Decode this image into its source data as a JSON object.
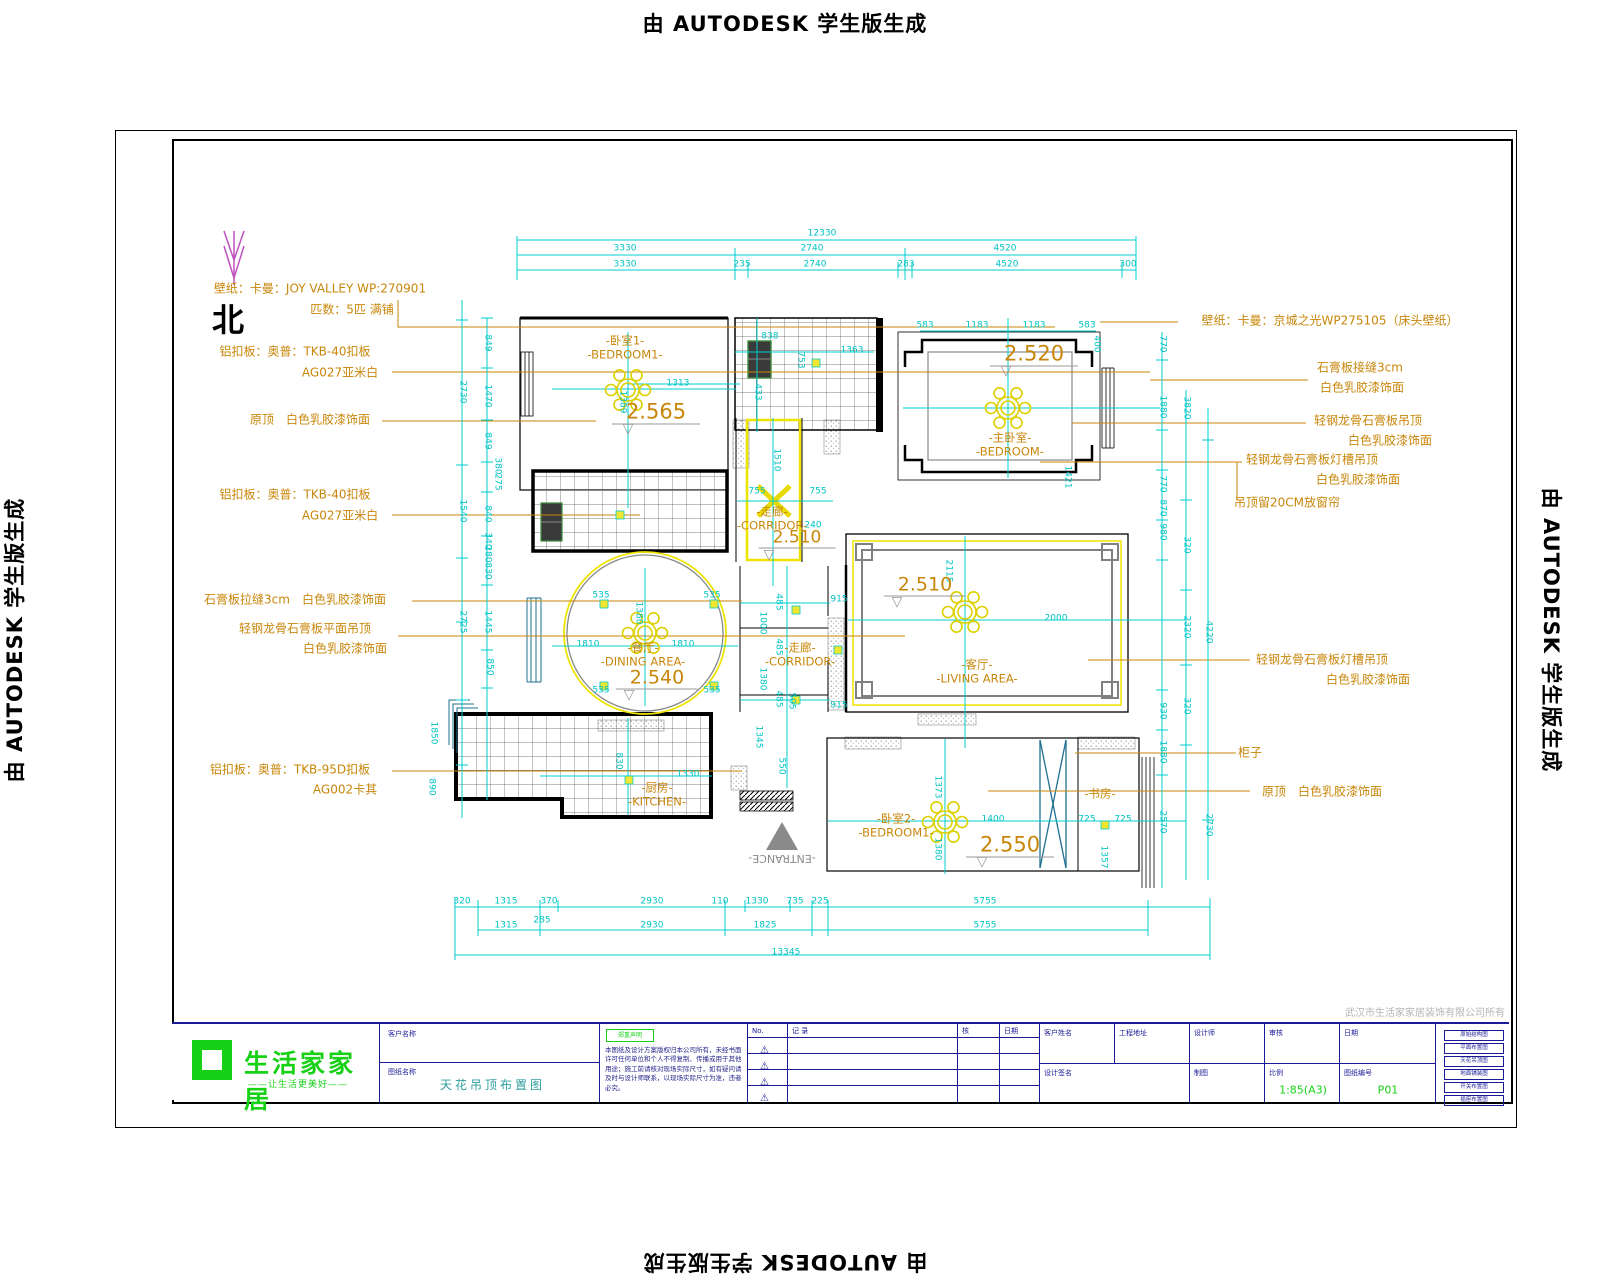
{
  "watermark": {
    "text": "由 AUTODESK 学生版生成"
  },
  "north_label": "北",
  "company_note": "武汉市生活家家居装饰有限公司所有",
  "plan": {
    "annotations": [
      {
        "t": "壁纸：卡曼：JOY VALLEY WP:270901",
        "x": 320,
        "y": 289
      },
      {
        "t": "匹数：5匹 满铺",
        "x": 352,
        "y": 310
      },
      {
        "t": "铝扣板：奥普：TKB-40扣板",
        "x": 295,
        "y": 352
      },
      {
        "t": "AG027亚米白",
        "x": 340,
        "y": 373
      },
      {
        "t": "原顶　白色乳胶漆饰面",
        "x": 310,
        "y": 420
      },
      {
        "t": "铝扣板：奥普：TKB-40扣板",
        "x": 295,
        "y": 495
      },
      {
        "t": "AG027亚米白",
        "x": 340,
        "y": 516
      },
      {
        "t": "石膏板拉缝3cm　白色乳胶漆饰面",
        "x": 295,
        "y": 600
      },
      {
        "t": "轻钢龙骨石膏板平面吊顶",
        "x": 305,
        "y": 629
      },
      {
        "t": "白色乳胶漆饰面",
        "x": 345,
        "y": 649
      },
      {
        "t": "铝扣板：奥普：TKB-95D扣板",
        "x": 290,
        "y": 770
      },
      {
        "t": "AG002卡其",
        "x": 345,
        "y": 790
      },
      {
        "t": "壁纸：卡曼：京城之光WP275105（床头壁纸）",
        "x": 1330,
        "y": 321
      },
      {
        "t": "石膏板接缝3cm",
        "x": 1360,
        "y": 368
      },
      {
        "t": "白色乳胶漆饰面",
        "x": 1362,
        "y": 388
      },
      {
        "t": "轻钢龙骨石膏板吊顶",
        "x": 1368,
        "y": 421
      },
      {
        "t": "白色乳胶漆饰面",
        "x": 1390,
        "y": 441
      },
      {
        "t": "轻钢龙骨石膏板灯槽吊顶",
        "x": 1312,
        "y": 460
      },
      {
        "t": "白色乳胶漆饰面",
        "x": 1358,
        "y": 480
      },
      {
        "t": "吊顶留20CM放窗帘",
        "x": 1287,
        "y": 503
      },
      {
        "t": "轻钢龙骨石膏板灯槽吊顶",
        "x": 1322,
        "y": 660
      },
      {
        "t": "白色乳胶漆饰面",
        "x": 1368,
        "y": 680
      },
      {
        "t": "柜子",
        "x": 1250,
        "y": 753
      },
      {
        "t": "原顶　白色乳胶漆饰面",
        "x": 1322,
        "y": 792
      },
      {
        "t": "-ENTRANCE-",
        "x": 782,
        "y": 858,
        "r": 180,
        "c": "#8a8a8a",
        "s": 11
      }
    ],
    "rooms": [
      {
        "cn": "-卧室1-",
        "en": "-BEDROOM1-",
        "x": 625,
        "y": 341
      },
      {
        "cn": "-主卧室-",
        "en": "-BEDROOM-",
        "x": 1010,
        "y": 438
      },
      {
        "cn": "-走廊-",
        "en": "-CORRIDOR-",
        "x": 772,
        "y": 512
      },
      {
        "cn": "-餐厅-",
        "en": "-DINING AREA-",
        "x": 643,
        "y": 648
      },
      {
        "cn": "-走廊-",
        "en": "-CORRIDOR-",
        "x": 800,
        "y": 648
      },
      {
        "cn": "-客厅-",
        "en": "-LIVING AREA-",
        "x": 977,
        "y": 665
      },
      {
        "cn": "-厨房-",
        "en": "-KITCHEN-",
        "x": 657,
        "y": 788
      },
      {
        "cn": "-卧室2-",
        "en": "-BEDROOM1-",
        "x": 896,
        "y": 819
      },
      {
        "cn": "-书房-",
        "en": "",
        "x": 1100,
        "y": 794
      }
    ],
    "levels": [
      {
        "t": "2.565",
        "x": 656,
        "y": 413,
        "s": 21
      },
      {
        "t": "2.520",
        "x": 1034,
        "y": 355,
        "s": 21
      },
      {
        "t": "2.510",
        "x": 797,
        "y": 539,
        "s": 17
      },
      {
        "t": "2.540",
        "x": 657,
        "y": 679,
        "s": 19
      },
      {
        "t": "2.510",
        "x": 925,
        "y": 586,
        "s": 19
      },
      {
        "t": "2.550",
        "x": 1010,
        "y": 846,
        "s": 21
      }
    ],
    "dims": [
      {
        "t": "12330",
        "x": 822,
        "y": 234
      },
      {
        "t": "3330",
        "x": 625,
        "y": 249
      },
      {
        "t": "2740",
        "x": 812,
        "y": 249
      },
      {
        "t": "4520",
        "x": 1005,
        "y": 249
      },
      {
        "t": "3330",
        "x": 625,
        "y": 265
      },
      {
        "t": "235",
        "x": 742,
        "y": 265
      },
      {
        "t": "2740",
        "x": 815,
        "y": 265
      },
      {
        "t": "283",
        "x": 906,
        "y": 265
      },
      {
        "t": "4520",
        "x": 1007,
        "y": 265
      },
      {
        "t": "300",
        "x": 1128,
        "y": 265
      },
      {
        "t": "320",
        "x": 462,
        "y": 902
      },
      {
        "t": "1315",
        "x": 506,
        "y": 902
      },
      {
        "t": "370",
        "x": 549,
        "y": 902
      },
      {
        "t": "2930",
        "x": 652,
        "y": 902
      },
      {
        "t": "110",
        "x": 720,
        "y": 902
      },
      {
        "t": "1330",
        "x": 757,
        "y": 902
      },
      {
        "t": "735",
        "x": 795,
        "y": 902
      },
      {
        "t": "225",
        "x": 820,
        "y": 902
      },
      {
        "t": "5755",
        "x": 985,
        "y": 902
      },
      {
        "t": "1315",
        "x": 506,
        "y": 926
      },
      {
        "t": "285",
        "x": 542,
        "y": 921
      },
      {
        "t": "2930",
        "x": 652,
        "y": 926
      },
      {
        "t": "1825",
        "x": 765,
        "y": 926
      },
      {
        "t": "5755",
        "x": 985,
        "y": 926
      },
      {
        "t": "13345",
        "x": 786,
        "y": 953
      },
      {
        "t": "849",
        "x": 487,
        "y": 343,
        "r": 90
      },
      {
        "t": "2730",
        "x": 462,
        "y": 392,
        "r": 90
      },
      {
        "t": "1470",
        "x": 487,
        "y": 396,
        "r": 90
      },
      {
        "t": "849",
        "x": 487,
        "y": 441,
        "r": 90
      },
      {
        "t": "380",
        "x": 497,
        "y": 466,
        "r": 90
      },
      {
        "t": "275",
        "x": 497,
        "y": 482,
        "r": 90
      },
      {
        "t": "1540",
        "x": 462,
        "y": 511,
        "r": 90
      },
      {
        "t": "840",
        "x": 487,
        "y": 514,
        "r": 90
      },
      {
        "t": "340",
        "x": 487,
        "y": 541,
        "r": 90
      },
      {
        "t": "280",
        "x": 487,
        "y": 554,
        "r": 90
      },
      {
        "t": "830",
        "x": 487,
        "y": 571,
        "r": 90
      },
      {
        "t": "2725",
        "x": 462,
        "y": 622,
        "r": 90
      },
      {
        "t": "1445",
        "x": 487,
        "y": 622,
        "r": 90
      },
      {
        "t": "850",
        "x": 489,
        "y": 667,
        "r": 90
      },
      {
        "t": "1850",
        "x": 433,
        "y": 733,
        "r": 90
      },
      {
        "t": "890",
        "x": 431,
        "y": 787,
        "r": 90
      },
      {
        "t": "770",
        "x": 1162,
        "y": 344,
        "r": 90
      },
      {
        "t": "1880",
        "x": 1162,
        "y": 407,
        "r": 90
      },
      {
        "t": "770",
        "x": 1162,
        "y": 484,
        "r": 90
      },
      {
        "t": "870",
        "x": 1162,
        "y": 508,
        "r": 90
      },
      {
        "t": "980",
        "x": 1162,
        "y": 532,
        "r": 90
      },
      {
        "t": "930",
        "x": 1162,
        "y": 711,
        "r": 90
      },
      {
        "t": "1880",
        "x": 1162,
        "y": 752,
        "r": 90
      },
      {
        "t": "2570",
        "x": 1162,
        "y": 822,
        "r": 90
      },
      {
        "t": "3820",
        "x": 1186,
        "y": 408,
        "r": 90
      },
      {
        "t": "320",
        "x": 1186,
        "y": 545,
        "r": 90
      },
      {
        "t": "2320",
        "x": 1186,
        "y": 627,
        "r": 90
      },
      {
        "t": "320",
        "x": 1186,
        "y": 706,
        "r": 90
      },
      {
        "t": "4220",
        "x": 1208,
        "y": 632,
        "r": 90
      },
      {
        "t": "2730",
        "x": 1208,
        "y": 825,
        "r": 90
      },
      {
        "t": "1313",
        "x": 678,
        "y": 384
      },
      {
        "t": "1389",
        "x": 622,
        "y": 402,
        "r": 90
      },
      {
        "t": "838",
        "x": 770,
        "y": 337
      },
      {
        "t": "433",
        "x": 757,
        "y": 392,
        "r": 90
      },
      {
        "t": "1363",
        "x": 852,
        "y": 351
      },
      {
        "t": "753",
        "x": 800,
        "y": 360,
        "r": 90
      },
      {
        "t": "583",
        "x": 925,
        "y": 326
      },
      {
        "t": "1183",
        "x": 977,
        "y": 326
      },
      {
        "t": "1183",
        "x": 1034,
        "y": 326
      },
      {
        "t": "583",
        "x": 1087,
        "y": 326
      },
      {
        "t": "400",
        "x": 1096,
        "y": 344,
        "r": 90
      },
      {
        "t": "1421",
        "x": 1067,
        "y": 477,
        "r": 90
      },
      {
        "t": "1510",
        "x": 776,
        "y": 460,
        "r": 90
      },
      {
        "t": "755",
        "x": 757,
        "y": 492
      },
      {
        "t": "755",
        "x": 818,
        "y": 492
      },
      {
        "t": "240",
        "x": 813,
        "y": 526
      },
      {
        "t": "535",
        "x": 601,
        "y": 596
      },
      {
        "t": "535",
        "x": 712,
        "y": 596
      },
      {
        "t": "535",
        "x": 601,
        "y": 691
      },
      {
        "t": "535",
        "x": 712,
        "y": 691
      },
      {
        "t": "1810",
        "x": 588,
        "y": 645
      },
      {
        "t": "1810",
        "x": 683,
        "y": 645
      },
      {
        "t": "1380",
        "x": 638,
        "y": 613,
        "r": 90
      },
      {
        "t": "915",
        "x": 839,
        "y": 600
      },
      {
        "t": "915",
        "x": 839,
        "y": 706
      },
      {
        "t": "485",
        "x": 778,
        "y": 602,
        "r": 90
      },
      {
        "t": "485",
        "x": 778,
        "y": 647,
        "r": 90
      },
      {
        "t": "485",
        "x": 778,
        "y": 699,
        "r": 90
      },
      {
        "t": "1000",
        "x": 762,
        "y": 623,
        "r": 90
      },
      {
        "t": "1380",
        "x": 762,
        "y": 679,
        "r": 90
      },
      {
        "t": "505",
        "x": 791,
        "y": 701,
        "r": 90
      },
      {
        "t": "1345",
        "x": 758,
        "y": 737,
        "r": 90
      },
      {
        "t": "550",
        "x": 781,
        "y": 766,
        "r": 90
      },
      {
        "t": "2115",
        "x": 948,
        "y": 571,
        "r": 90
      },
      {
        "t": "2000",
        "x": 1056,
        "y": 619
      },
      {
        "t": "1330",
        "x": 688,
        "y": 775
      },
      {
        "t": "830",
        "x": 618,
        "y": 761,
        "r": 90
      },
      {
        "t": "1373",
        "x": 937,
        "y": 787,
        "r": 90
      },
      {
        "t": "1380",
        "x": 937,
        "y": 849,
        "r": 90
      },
      {
        "t": "1400",
        "x": 993,
        "y": 820
      },
      {
        "t": "725",
        "x": 1087,
        "y": 820
      },
      {
        "t": "725",
        "x": 1123,
        "y": 820
      },
      {
        "t": "1357",
        "x": 1103,
        "y": 857,
        "r": 90
      }
    ]
  },
  "titleblock": {
    "logo_text": "生活家家居",
    "logo_sub": "——让生活更美好——",
    "field1_label": "客户名称",
    "field2_label": "图纸名称",
    "drawing_title": "天花吊顶布置图",
    "notes_header": "郑重声明",
    "notes_body": "本图纸及设计方案版权归本公司所有，未经书面许可任何单位和个人不得复制、传播或用于其他用途；施工前请核对现场实际尺寸，如有疑问请及时与设计师联系，以现场实际尺寸为准，违者必究。",
    "rev": {
      "no_label": "No.",
      "desc_label": "记 录",
      "by_label": "核",
      "date_label": "日期",
      "icon": "⚠"
    },
    "fields": {
      "f1": "客户姓名",
      "f2": "工程地址",
      "f3": "设计师",
      "f4": "审核",
      "f5": "日期",
      "sign_label": "设计签名",
      "draw_label": "制图",
      "scale_label": "比例",
      "scale_value": "1:85(A3)",
      "sheet_label": "图纸编号",
      "sheet_value": "P01"
    }
  },
  "sidelist": [
    "原始结构图",
    "平面布置图",
    "天花吊顶图",
    "地面铺装图",
    "开关布置图",
    "插座布置图"
  ]
}
